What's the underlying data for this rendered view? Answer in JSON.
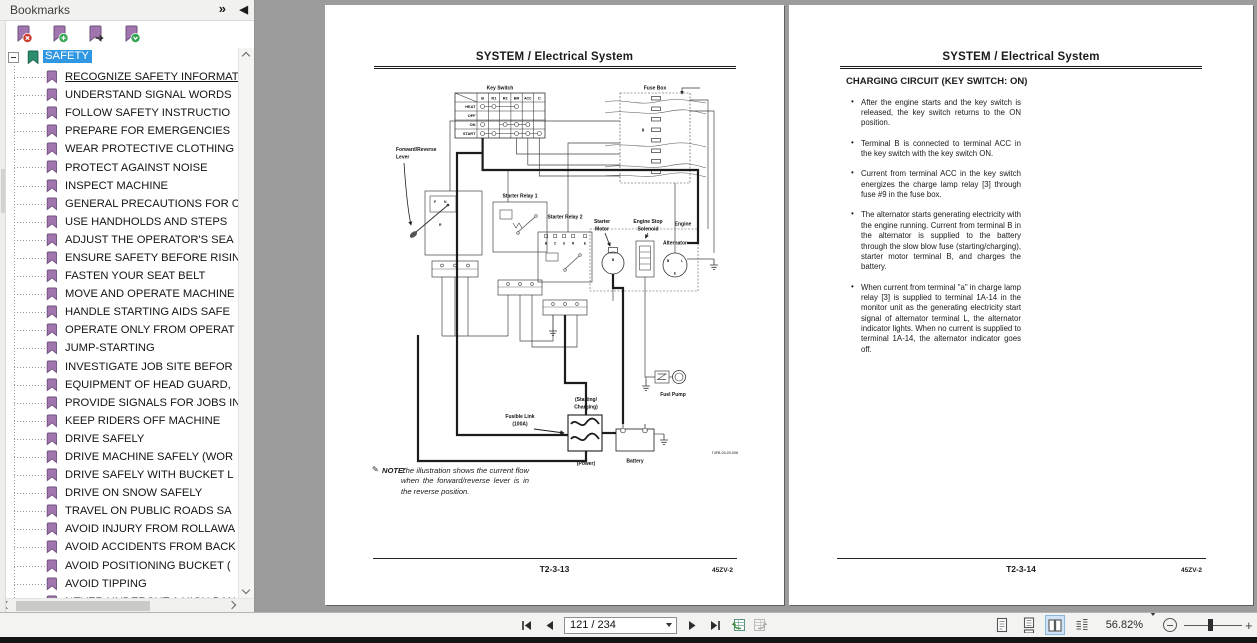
{
  "icons": {
    "panel_options": "»",
    "panel_collapse": "◀",
    "note": "✎",
    "zoom_in": "+"
  },
  "bookmarks_panel": {
    "title": "Bookmarks",
    "root": "SAFETY",
    "items": [
      "RECOGNIZE SAFETY INFORMAT",
      "UNDERSTAND SIGNAL WORDS",
      "FOLLOW SAFETY INSTRUCTIO",
      "PREPARE FOR EMERGENCIES",
      "WEAR PROTECTIVE CLOTHING",
      "PROTECT AGAINST NOISE",
      "INSPECT MACHINE",
      "GENERAL PRECAUTIONS FOR C",
      "USE HANDHOLDS AND STEPS",
      "ADJUST THE OPERATOR'S SEA",
      "ENSURE SAFETY BEFORE RISIN",
      "FASTEN YOUR SEAT BELT",
      "MOVE AND OPERATE MACHINE",
      "HANDLE STARTING AIDS SAFE",
      "OPERATE ONLY FROM OPERAT",
      "JUMP-STARTING",
      "INVESTIGATE JOB SITE BEFOR",
      "EQUIPMENT OF HEAD GUARD,",
      "PROVIDE SIGNALS FOR JOBS IN",
      "KEEP RIDERS OFF MACHINE",
      "DRIVE SAFELY",
      "DRIVE MACHINE SAFELY (WOR",
      "DRIVE SAFELY WITH BUCKET L",
      "DRIVE ON SNOW SAFELY",
      "TRAVEL ON PUBLIC ROADS SA",
      "AVOID INJURY FROM ROLLAWA",
      "AVOID ACCIDENTS FROM BACK",
      "AVOID POSITIONING BUCKET (",
      "AVOID TIPPING",
      "NEVER UNDERCUT A HIGH BAN"
    ]
  },
  "left_page": {
    "title": "SYSTEM / Electrical System",
    "note_label": "NOTE:",
    "note_text": "The illustration shows the current flow when the forward/reverse lever is in the reverse position.",
    "footer": {
      "page_code": "T2-3-13",
      "doc_code": "45ZV-2"
    },
    "diagram": {
      "key_switch": {
        "title": "Key Switch",
        "columns": [
          "B",
          "R1",
          "R2",
          "BR",
          "ACC",
          "C"
        ],
        "rows": [
          "HEAT",
          "OFF",
          "ON",
          "START"
        ]
      },
      "fuse_box": {
        "title": "Fuse Box",
        "fuse_number": "9"
      },
      "labels": {
        "forward_reverse_lever": [
          "Forward/Reverse",
          "Lever"
        ],
        "starter_relay_1": "Starter Relay 1",
        "starter_relay_2": "Starter Relay 2",
        "starter_motor": [
          "Starter",
          "Motor"
        ],
        "engine_stop_solenoid": [
          "Engine Stop",
          "Solenoid"
        ],
        "engine": "Engine",
        "alternator": "Alternator",
        "starting_charging": [
          "(Starting/",
          "Charging)"
        ],
        "fusible_link": [
          "Fusible Link",
          "(100A)"
        ],
        "power": "(Power)",
        "battery": "Battery",
        "fuel_pump": "Fuel Pump",
        "figure_code": "T4FB-03-03-006"
      },
      "terminals": {
        "lever": [
          "F",
          "N",
          "R"
        ],
        "relay2": [
          "B",
          "C",
          "S",
          "R",
          "E"
        ],
        "starter_motor_b": "B",
        "alternator_b": "B",
        "alternator_l": "L",
        "alternator_e": "E"
      }
    }
  },
  "right_page": {
    "title": "SYSTEM / Electrical System",
    "heading": "CHARGING CIRCUIT (KEY SWITCH: ON)",
    "bullets": [
      "After the engine starts and the key switch is released, the key switch returns to the ON position.",
      "Terminal B is connected to terminal ACC in the key switch with the key switch ON.",
      "Current from terminal ACC in the key switch energizes the charge lamp relay [3] through fuse #9 in the fuse box.",
      "The alternator starts generating electricity with the engine running. Current from terminal B in the alternator is supplied to the battery through the slow blow fuse (starting/charging), starter motor terminal B, and charges the battery.",
      "When current from terminal \"a\" in charge lamp relay [3] is supplied to terminal 1A-14 in the monitor unit as the generating electricity start signal of alternator terminal L, the alternator indicator lights. When no current is supplied to terminal 1A-14, the alternator indicator goes off."
    ],
    "footer": {
      "page_code": "T2-3-14",
      "doc_code": "45ZV-2"
    }
  },
  "status_bar": {
    "page_input": "121 / 234",
    "zoom_percent": "56.82%"
  }
}
